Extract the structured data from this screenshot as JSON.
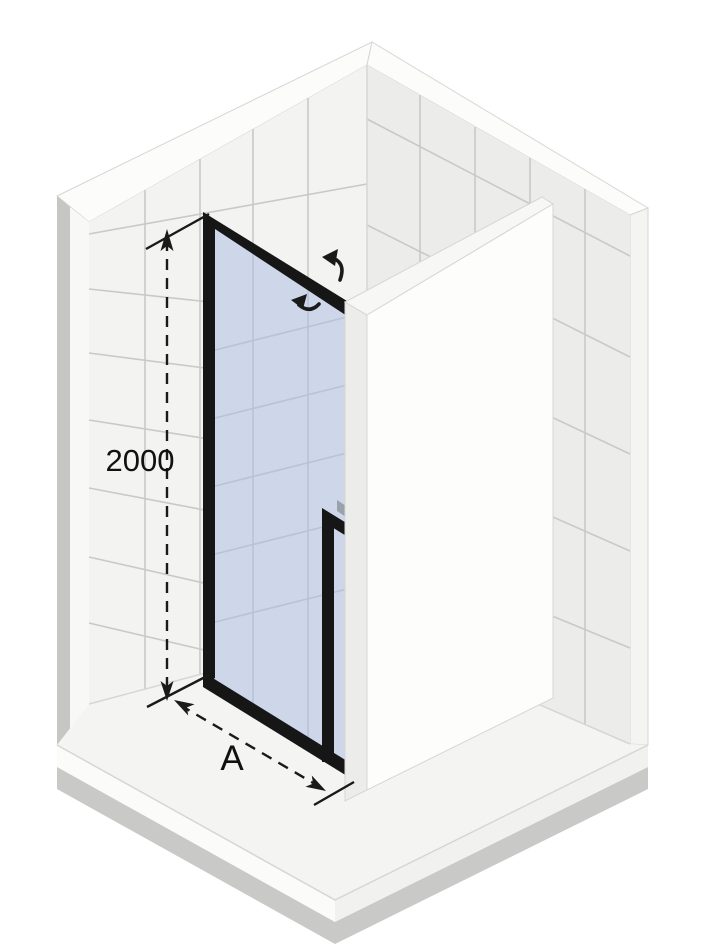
{
  "diagram": {
    "type": "isometric-technical-drawing",
    "dimensions": {
      "height_label": "2000",
      "width_label": "A"
    },
    "icons": {
      "swing_open": "door-swing-arrow-outward-icon",
      "swing_close": "door-swing-arrow-inward-icon",
      "height_arrows": "double-ended-vertical-dimension-arrow",
      "width_arrows": "double-ended-diagonal-dimension-arrow"
    },
    "colors": {
      "background": "#ffffff",
      "wall_tile_left": "#f3f3f1",
      "wall_tile_right": "#ececea",
      "grout": "#c9c9c7",
      "band": "#fcfcfb",
      "edge_light": "#f8f8f6",
      "side_shadow": "#c6c6c5",
      "floor": "#f4f4f2",
      "floor_edge": "#fbfbfa",
      "floor_shadow": "#c9c9c8",
      "glass": "#cdd7e9",
      "glass_line": "#b9c3d8",
      "frame": "#161616",
      "handle_cap": "#99a1ab",
      "panel": "#fdfdfc",
      "panel_edge": "#ececea",
      "seam": "#d6d6d4",
      "annotation": "#1a1a1a"
    }
  }
}
